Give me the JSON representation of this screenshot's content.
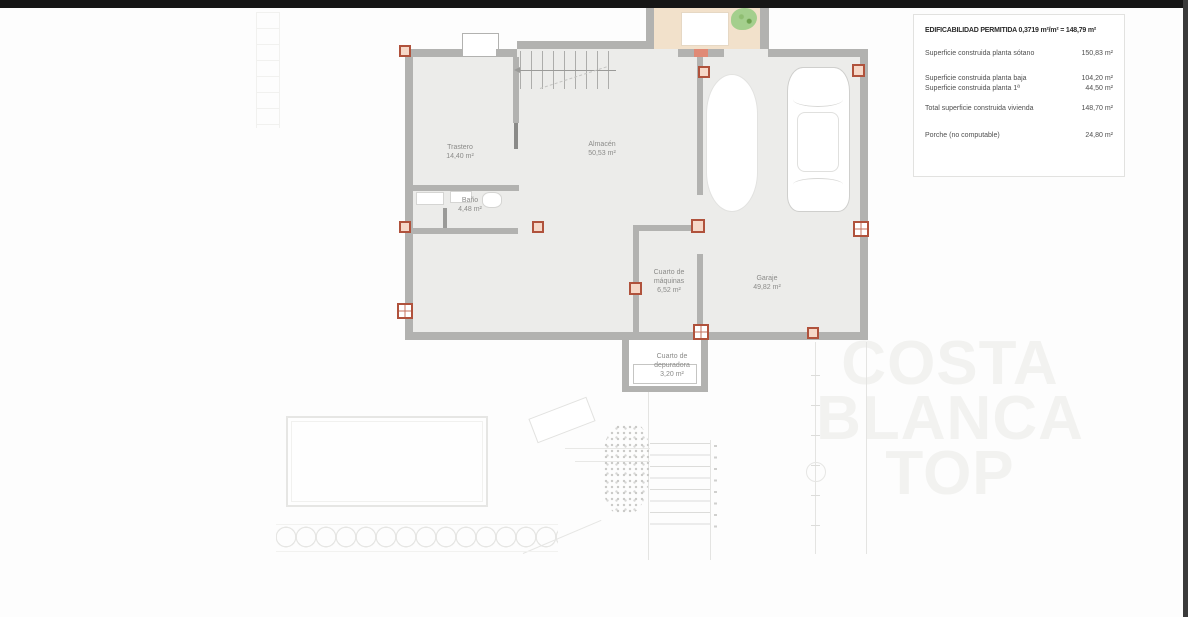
{
  "info_box": {
    "title": "EDIFICABILIDAD PERMITIDA 0,3719 m²/m² = 148,79 m²",
    "rows": [
      {
        "label": "Superficie construida planta sótano",
        "value": "150,83 m²"
      },
      {
        "label": "Superficie construida planta baja",
        "value": "104,20 m²"
      },
      {
        "label": "Superficie construida planta 1ª",
        "value": "44,50 m²"
      },
      {
        "label": "Total superficie construida vivienda",
        "value": "148,70 m²"
      },
      {
        "label": "Porche (no computable)",
        "value": "24,80 m²"
      }
    ]
  },
  "rooms": [
    {
      "name": "Trastero",
      "area": "14,40 m²"
    },
    {
      "name": "Almacén",
      "area": "50,53 m²"
    },
    {
      "name": "Baño",
      "area": "4,48 m²"
    },
    {
      "name": "Cuarto de máquinas",
      "area": "6,52 m²"
    },
    {
      "name": "Garaje",
      "area": "49,82 m²"
    },
    {
      "name": "Cuarto de depuradora",
      "area": "3,20 m²"
    }
  ],
  "watermark": {
    "line1": "COSTA",
    "line2": "BLANCA",
    "line3": "TOP"
  },
  "colors": {
    "wall": "#b2b2b0",
    "floor": "#ececea",
    "terrace": "#f2e1cb",
    "column_accent": "#b0523c",
    "watermark": "#f2f2f0",
    "top_bar": "#161616",
    "right_bar": "#3a3a3a"
  }
}
